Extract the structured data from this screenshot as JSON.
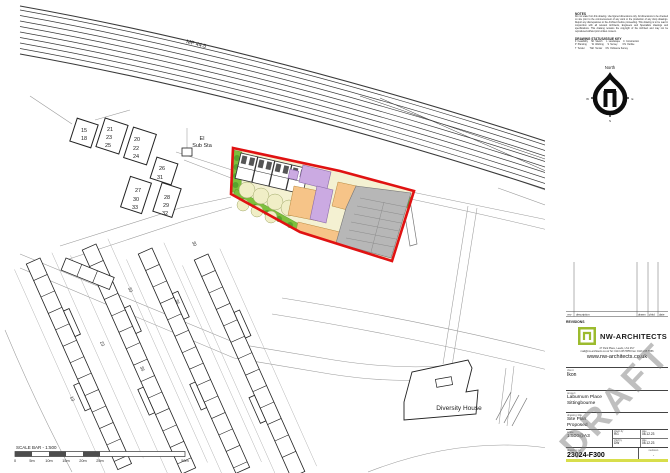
{
  "page": {
    "watermark": "DRAFT"
  },
  "colors": {
    "boundary_red": "#e01212",
    "landscape_green": "#7dbf3c",
    "housing_purple": "#cbaae2",
    "courtyard_orange": "#f6c488",
    "parking_grey": "#b7b7b7",
    "brand_green": "#9cbb2e",
    "accent_lime": "#d8de4b"
  },
  "map": {
    "mp_label": "MP 44.5",
    "el_line1": "El",
    "el_line2": "Sub Sta",
    "diversity_house": "Diversity House",
    "house_blocks": {
      "a1": "15",
      "a2": "18",
      "b1": "21",
      "b2": "23",
      "b3": "25",
      "c1": "20",
      "c2": "22",
      "c3": "24",
      "d1": "26",
      "d2": "31",
      "e1": "27",
      "e2": "30",
      "e3": "33",
      "f1": "28",
      "f2": "29",
      "f3": "32"
    },
    "street_numbers": {
      "n1": "33",
      "n2": "23",
      "n3": "36",
      "n4": "13",
      "n5": "30",
      "n6": "36"
    }
  },
  "scale_bar": {
    "label": "SCALE BAR - 1:500",
    "t0": "0",
    "t1": "5m",
    "t2": "10m",
    "t3": "15m",
    "t4": "20m",
    "t5": "25m",
    "t6": "50m"
  },
  "notes": {
    "heading": "NOTES",
    "body": "Do not scale from this drawing. Use figured dimensions only. All dimensions to be checked on site prior to the commencement of any work or the production of any shop drawings. Report any discrepancies to the Architect before proceeding. This drawing is to be read in conjunction with all relevant Architects, Engineers and Specialists drawings and specifications. This drawing remains the copyright of the Architect and may not be reproduced without prior written consent.",
    "key_heading": "DRAWING STATUS/ISSUE KEY",
    "key_row1": "F  Feasibility     SK  Sketch      L  Landscape     C  Construction",
    "key_row2": "P  Planning        W  Working      S  Survey        OS  Outline",
    "key_row3": "T  Tender        T&F  Tender     OS  Ordnance Survey"
  },
  "north": {
    "label": "North",
    "w": "W",
    "e": "E",
    "s": "S"
  },
  "revisions": {
    "rev": "rev",
    "description": "description",
    "drawn": "drawn",
    "chkd": "chkd",
    "date": "date",
    "footer": "REVISIONS"
  },
  "firm": {
    "name": "NW-ARCHITECTS",
    "address_line": "27 Park Place, Leeds, LS1 2SY",
    "contact_line": "mail@nw-architects.co.uk   Tel: 0113 245 5555   Fax: 0113 245 5556",
    "website": "www.nw-architects.co.uk"
  },
  "titleblock": {
    "client_label": "client",
    "client": "Ikon",
    "project_label": "project",
    "project_line1": "Laburnum Place",
    "project_line2": "Sittingbourne",
    "title_label": "drawing title",
    "title_line1": "Site Plan",
    "title_line2": "Proposed",
    "scale_label": "scale",
    "scale": "1:500@A3",
    "drawn_label": "drawn by",
    "drawn": "RG",
    "drawn_date_label": "date",
    "drawn_date": "08.12.23",
    "checked_label": "chkd by",
    "checked": "DW",
    "checked_date_label": "date",
    "checked_date": "08.12.23",
    "number_label": "drawing no.",
    "number": "23024-F300",
    "revision_label": "revision",
    "revision": "-"
  }
}
